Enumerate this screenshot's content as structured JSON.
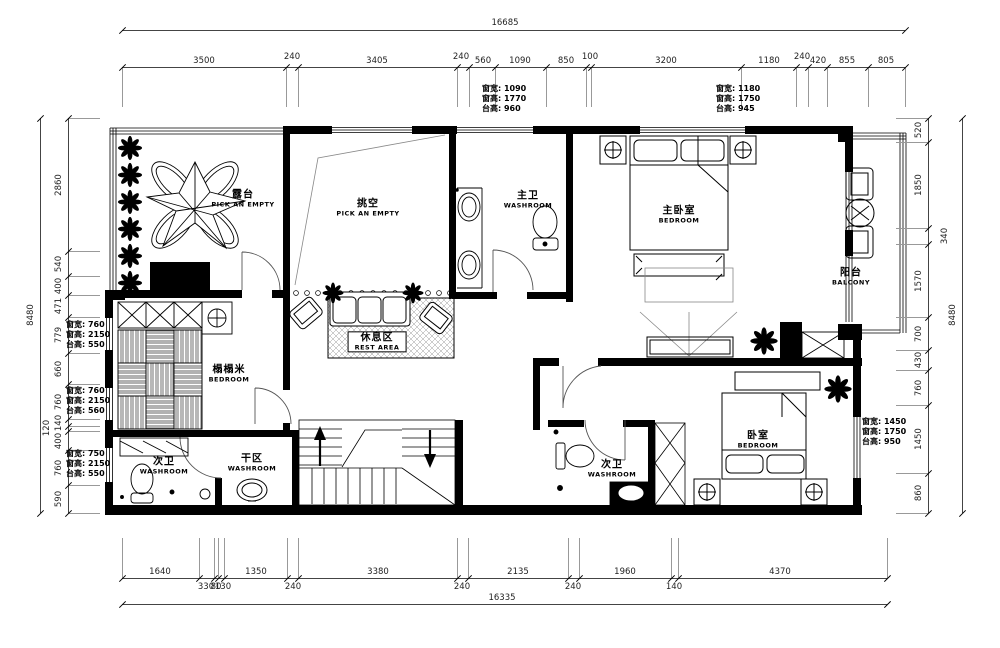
{
  "plan": {
    "rooms": [
      {
        "cn": "露台",
        "en": "PICK AN EMPTY",
        "x": 243,
        "y": 199,
        "boxed": false
      },
      {
        "cn": "挑空",
        "en": "PICK AN EMPTY",
        "x": 368,
        "y": 208,
        "boxed": false
      },
      {
        "cn": "主卫",
        "en": "WASHROOM",
        "x": 528,
        "y": 200,
        "boxed": false
      },
      {
        "cn": "主卧室",
        "en": "BEDROOM",
        "x": 679,
        "y": 215,
        "boxed": false
      },
      {
        "cn": "阳台",
        "en": "BALCONY",
        "x": 851,
        "y": 277,
        "boxed": false
      },
      {
        "cn": "榻榻米",
        "en": "BEDROOM",
        "x": 229,
        "y": 374,
        "boxed": false
      },
      {
        "cn": "休息区",
        "en": "REST AREA",
        "x": 377,
        "y": 342,
        "boxed": true
      },
      {
        "cn": "次卫",
        "en": "WASHROOM",
        "x": 164,
        "y": 466,
        "boxed": false
      },
      {
        "cn": "干区",
        "en": "WASHROOM",
        "x": 252,
        "y": 463,
        "boxed": false
      },
      {
        "cn": "次卫",
        "en": "WASHROOM",
        "x": 612,
        "y": 469,
        "boxed": false
      },
      {
        "cn": "卧室",
        "en": "BEDROOM",
        "x": 758,
        "y": 440,
        "boxed": false
      }
    ],
    "window_specs": [
      {
        "x": 482,
        "y": 84,
        "lines": [
          "窗宽: 1090",
          "窗高: 1770",
          "台高: 960"
        ]
      },
      {
        "x": 716,
        "y": 84,
        "lines": [
          "窗宽: 1180",
          "窗高: 1750",
          "台高: 945"
        ]
      },
      {
        "x": 66,
        "y": 320,
        "lines": [
          "窗宽: 760",
          "窗高: 2150",
          "台高: 550"
        ]
      },
      {
        "x": 66,
        "y": 386,
        "lines": [
          "窗宽: 760",
          "窗高: 2150",
          "台高: 560"
        ]
      },
      {
        "x": 66,
        "y": 449,
        "lines": [
          "窗宽: 750",
          "窗高: 2150",
          "台高: 550"
        ]
      },
      {
        "x": 862,
        "y": 417,
        "lines": [
          "窗宽: 1450",
          "窗高: 1750",
          "台高: 950"
        ]
      }
    ],
    "dimensions": {
      "rows": [
        {
          "id": "dim-top-total",
          "dir": "h",
          "line": 30,
          "from": 122,
          "to": 905,
          "ticks": [
            122,
            905
          ],
          "ext": 0,
          "labels": [
            {
              "t": "16685",
              "p": 505,
              "o": -12
            }
          ]
        },
        {
          "id": "dim-top-segments",
          "dir": "h",
          "line": 67,
          "from": 122,
          "to": 905,
          "ticks": [
            122,
            286,
            298,
            457,
            469,
            495,
            546,
            586,
            591,
            741,
            796,
            808,
            827,
            868,
            905
          ],
          "ext": 40,
          "labels": [
            {
              "t": "3500",
              "p": 204,
              "o": -11
            },
            {
              "t": "240",
              "p": 292,
              "o": -15
            },
            {
              "t": "3405",
              "p": 377,
              "o": -11
            },
            {
              "t": "240",
              "p": 461,
              "o": -15
            },
            {
              "t": "560",
              "p": 483,
              "o": -11
            },
            {
              "t": "1090",
              "p": 520,
              "o": -11
            },
            {
              "t": "850",
              "p": 566,
              "o": -11
            },
            {
              "t": "100",
              "p": 590,
              "o": -15
            },
            {
              "t": "3200",
              "p": 666,
              "o": -11
            },
            {
              "t": "1180",
              "p": 769,
              "o": -11
            },
            {
              "t": "240",
              "p": 802,
              "o": -15
            },
            {
              "t": "420",
              "p": 818,
              "o": -11
            },
            {
              "t": "855",
              "p": 847,
              "o": -11
            },
            {
              "t": "805",
              "p": 886,
              "o": -11
            }
          ]
        },
        {
          "id": "dim-left-total",
          "dir": "v",
          "line": 40,
          "from": 118,
          "to": 513,
          "ticks": [
            118,
            513
          ],
          "ext": 0,
          "labels": [
            {
              "t": "8480",
              "p": 315,
              "o": -9
            }
          ]
        },
        {
          "id": "dim-left-segments",
          "dir": "v",
          "line": 68,
          "from": 118,
          "to": 513,
          "ticks": [
            118,
            251,
            276,
            295,
            317,
            353,
            384,
            419,
            426,
            431,
            450,
            485,
            513
          ],
          "ext": 32,
          "labels": [
            {
              "t": "2860",
              "p": 185,
              "o": -9
            },
            {
              "t": "540",
              "p": 264,
              "o": -9
            },
            {
              "t": "400",
              "p": 286,
              "o": -9
            },
            {
              "t": "471",
              "p": 306,
              "o": -9
            },
            {
              "t": "779",
              "p": 335,
              "o": -9
            },
            {
              "t": "660",
              "p": 369,
              "o": -9
            },
            {
              "t": "760",
              "p": 402,
              "o": -9
            },
            {
              "t": "140",
              "p": 423,
              "o": -9
            },
            {
              "t": "120",
              "p": 428,
              "o": -21
            },
            {
              "t": "400",
              "p": 441,
              "o": -9
            },
            {
              "t": "760",
              "p": 468,
              "o": -9
            },
            {
              "t": "590",
              "p": 499,
              "o": -9
            }
          ]
        },
        {
          "id": "dim-right-segments",
          "dir": "v",
          "line": 928,
          "from": 118,
          "to": 513,
          "ticks": [
            118,
            142,
            228,
            244,
            317,
            350,
            370,
            405,
            473,
            513
          ],
          "ext": -32,
          "labels": [
            {
              "t": "520",
              "p": 130,
              "o": -9
            },
            {
              "t": "1850",
              "p": 185,
              "o": -9
            },
            {
              "t": "340",
              "p": 236,
              "o": 17
            },
            {
              "t": "1570",
              "p": 281,
              "o": -9
            },
            {
              "t": "700",
              "p": 334,
              "o": -9
            },
            {
              "t": "430",
              "p": 360,
              "o": -9
            },
            {
              "t": "760",
              "p": 388,
              "o": -9
            },
            {
              "t": "1450",
              "p": 439,
              "o": -9
            },
            {
              "t": "860",
              "p": 493,
              "o": -9
            }
          ]
        },
        {
          "id": "dim-right-total",
          "dir": "v",
          "line": 962,
          "from": 118,
          "to": 513,
          "ticks": [
            118,
            513
          ],
          "ext": 0,
          "labels": [
            {
              "t": "8480",
              "p": 315,
              "o": -9
            }
          ]
        },
        {
          "id": "dim-bottom-segments",
          "dir": "h",
          "line": 578,
          "from": 122,
          "to": 887,
          "ticks": [
            122,
            199,
            214,
            218,
            224,
            287,
            298,
            457,
            468,
            568,
            579,
            671,
            678,
            887
          ],
          "ext": -40,
          "labels": [
            {
              "t": "1640",
              "p": 160,
              "o": -11
            },
            {
              "t": "330",
              "p": 206,
              "o": 4
            },
            {
              "t": "80",
              "p": 216,
              "o": 4
            },
            {
              "t": "130",
              "p": 223,
              "o": 4
            },
            {
              "t": "1350",
              "p": 256,
              "o": -11
            },
            {
              "t": "240",
              "p": 293,
              "o": 4
            },
            {
              "t": "3380",
              "p": 378,
              "o": -11
            },
            {
              "t": "240",
              "p": 462,
              "o": 4
            },
            {
              "t": "2135",
              "p": 518,
              "o": -11
            },
            {
              "t": "240",
              "p": 573,
              "o": 4
            },
            {
              "t": "1960",
              "p": 625,
              "o": -11
            },
            {
              "t": "140",
              "p": 674,
              "o": 4
            },
            {
              "t": "4370",
              "p": 780,
              "o": -11
            }
          ]
        },
        {
          "id": "dim-bottom-total",
          "dir": "h",
          "line": 604,
          "from": 122,
          "to": 887,
          "ticks": [
            122,
            887
          ],
          "ext": 0,
          "labels": [
            {
              "t": "16335",
              "p": 502,
              "o": -11
            }
          ]
        }
      ]
    }
  }
}
